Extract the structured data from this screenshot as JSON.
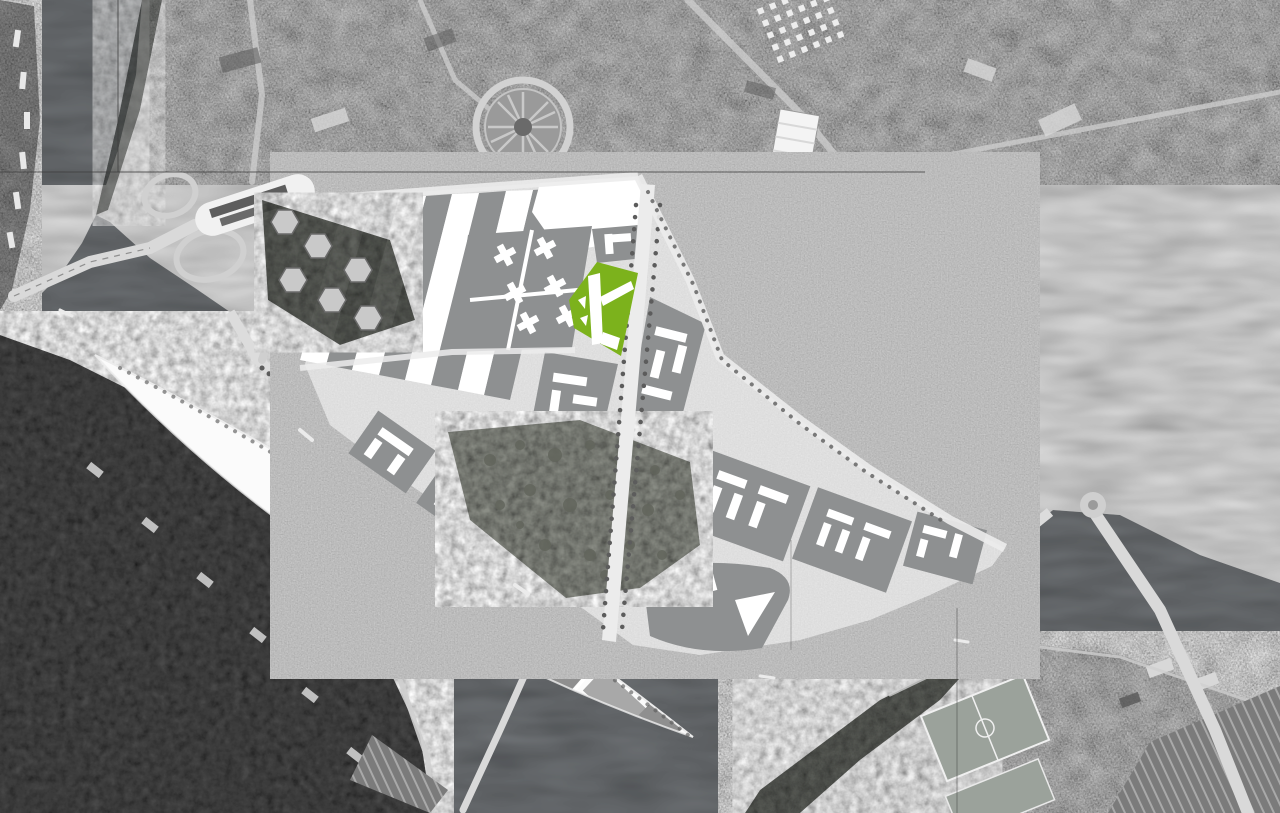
{
  "canvas": {
    "width": 1280,
    "height": 813
  },
  "map_type": "grayscale-aerial-orthophoto-with-masterplan-overlay",
  "palette": {
    "base_city": "#9b9b9b",
    "water": "#5d6063",
    "woods": "#484848",
    "port_strip": "#6f6f6f",
    "island_white": "#fbfbfb",
    "island_industrial": "#8f8f8f",
    "island_industrial_light": "#a8a8a8",
    "plan_street": "#dfdfdf",
    "plan_block": "#8e9091",
    "plan_white": "#ffffff",
    "parcel_green": "#7cb21c",
    "park_gray": "#8b8e86",
    "road_light": "#cfcfcf",
    "bridge_light": "#d9d9d9",
    "quay_light": "#dcdcdc",
    "tree_dark": "#5c5c5c",
    "boat_white": "#ebebeb",
    "building_light": "#d8d8d8",
    "building_dark": "#585858",
    "pitch_gray": "#9ba29b",
    "rail_gray": "#7b7b7b",
    "rail_line": "#a9a9a9",
    "seam": "#3f3f3f"
  },
  "features": [
    "seine-river",
    "river-port-strip",
    "left-bank-woods",
    "ile-seguin-island",
    "island-industrial-slabs",
    "ile-saint-germain",
    "sports-pitch",
    "rail-yard",
    "masterplan-overlay",
    "striped-blocks",
    "city-blocks",
    "central-park-band",
    "main-avenue",
    "highlighted-parcel",
    "pont-de-sevres-bridge",
    "bus-terminal-platform",
    "hexagon-towers",
    "island-crossing-north",
    "island-crossing-south",
    "billancourt-bridge",
    "roundabout",
    "photo-seam-lines"
  ],
  "highlight": {
    "feature": "highlighted-parcel",
    "color_ref": "parcel_green"
  }
}
